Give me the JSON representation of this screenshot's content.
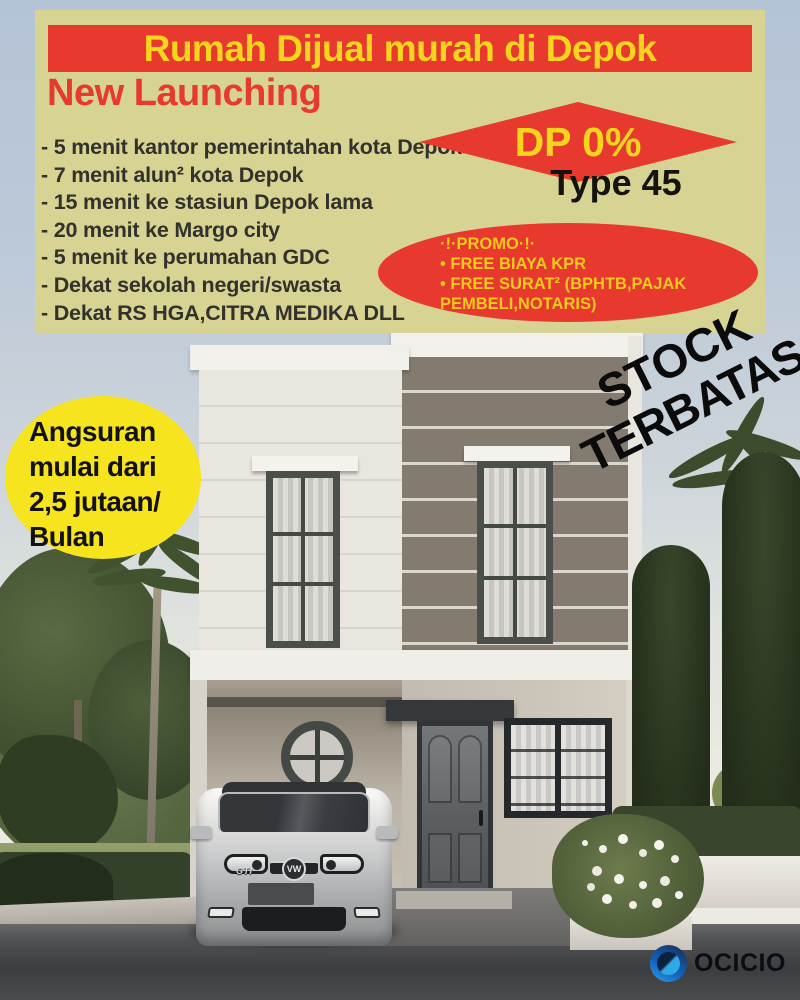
{
  "header": {
    "title": "Rumah Dijual murah di Depok",
    "subtitle": "New Launching"
  },
  "features": [
    "- 5 menit kantor pemerintahan kota Depok",
    "- 7 menit alun² kota Depok",
    "- 15 menit ke stasiun Depok lama",
    "- 20 menit ke Margo city",
    "- 5 menit ke perumahan GDC",
    "- Dekat sekolah negeri/swasta",
    "- Dekat RS HGA,CITRA MEDIKA DLL"
  ],
  "offer": {
    "dp": "DP 0%",
    "type": "Type 45"
  },
  "promo": {
    "header": "·!·PROMO·!·",
    "line1": "• FREE BIAYA KPR",
    "line2": "• FREE SURAT² (BPHTB,PAJAK PEMBELI,NOTARIS)"
  },
  "installment": {
    "line1": "Angsuran",
    "line2": "mulai dari",
    "line3": "2,5 jutaan/",
    "line4": "Bulan"
  },
  "stock": {
    "line1": "STOCK",
    "line2": "TERBATAS"
  },
  "car": {
    "badge": "GTI",
    "logo": "VW"
  },
  "brand": {
    "name": "OCICIO"
  },
  "colors": {
    "panel_bg": "#d7d493",
    "accent_red": "#e7392e",
    "accent_yellow": "#f7d51e",
    "bubble_yellow": "#f6e41f",
    "feature_text": "#32312b",
    "stock_text": "#0b0b0b",
    "brand_blue": "#1563c0"
  }
}
